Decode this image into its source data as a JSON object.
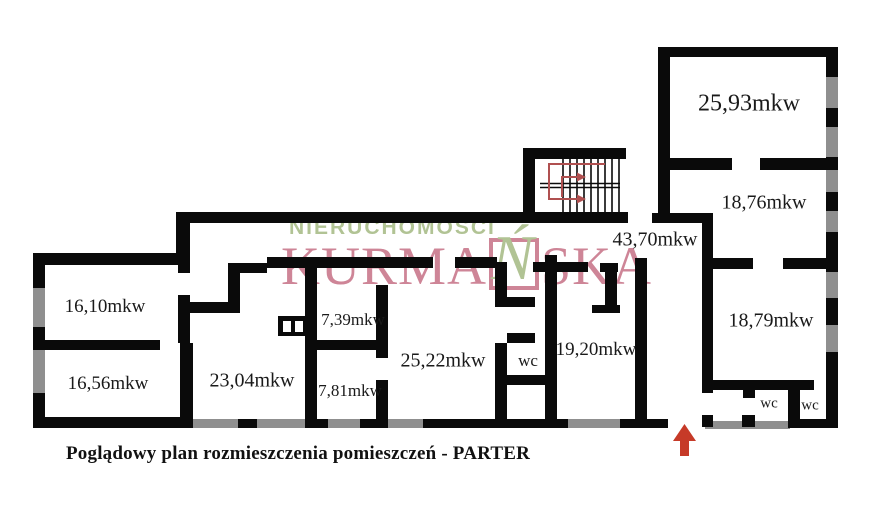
{
  "plan": {
    "caption": "Poglądowy plan rozmieszczenia pomieszczeń - PARTER",
    "rooms": [
      {
        "name": "room-16-10",
        "area": "16,10mkw"
      },
      {
        "name": "room-16-56",
        "area": "16,56mkw"
      },
      {
        "name": "room-23-04",
        "area": "23,04mkw"
      },
      {
        "name": "room-7-39",
        "area": "7,39mkw"
      },
      {
        "name": "room-7-81",
        "area": "7,81mkw"
      },
      {
        "name": "room-25-22",
        "area": "25,22mkw"
      },
      {
        "name": "wc-middle",
        "area": "wc"
      },
      {
        "name": "room-19-20",
        "area": "19,20mkw"
      },
      {
        "name": "corridor-43-70",
        "area": "43,70mkw"
      },
      {
        "name": "room-25-93",
        "area": "25,93mkw"
      },
      {
        "name": "room-18-76",
        "area": "18,76mkw"
      },
      {
        "name": "room-18-79",
        "area": "18,79mkw"
      },
      {
        "name": "wc-right-1",
        "area": "wc"
      },
      {
        "name": "wc-right-2",
        "area": "wc"
      }
    ]
  },
  "watermark": {
    "line1": "NIERUCHOMOŚCI",
    "brand_prefix": "KURMA",
    "brand_boxed_letter": "Ń",
    "brand_suffix": "SKA"
  },
  "colors": {
    "wall": "#0a0a0a",
    "window_gray": "#8f8f8f",
    "stair_path_red": "#b05050",
    "entrance_arrow_red": "#c63a28",
    "watermark_green": "#a9bd89",
    "watermark_pink": "#c9788c",
    "label_text": "#1a1a1a"
  }
}
